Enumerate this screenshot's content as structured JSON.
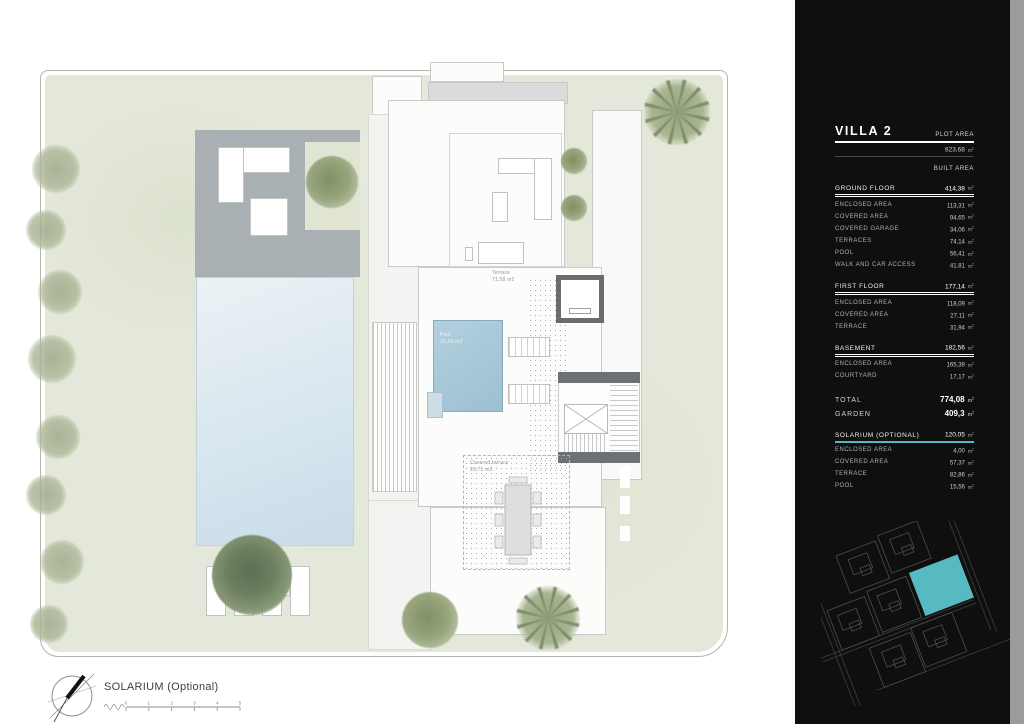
{
  "panel": {
    "title": "VILLA 2",
    "plot_area_label": "PLOT AREA",
    "plot_area_value": "823,68",
    "built_area_label": "BUILT AREA",
    "unit_base": "m",
    "unit_exp": "2",
    "sections": [
      {
        "name": "GROUND FLOOR",
        "value": "414,38",
        "rows": [
          {
            "label": "ENCLOSED AREA",
            "value": "113,31"
          },
          {
            "label": "COVERED AREA",
            "value": "94,65"
          },
          {
            "label": "COVERED GARAGE",
            "value": "34,06"
          },
          {
            "label": "TERRACES",
            "value": "74,14"
          },
          {
            "label": "POOL",
            "value": "56,41"
          },
          {
            "label": "WALK AND CAR ACCESS",
            "value": "41,81"
          }
        ]
      },
      {
        "name": "FIRST FLOOR",
        "value": "177,14",
        "rows": [
          {
            "label": "ENCLOSED AREA",
            "value": "118,09"
          },
          {
            "label": "COVERED AREA",
            "value": "27,11"
          },
          {
            "label": "TERRACE",
            "value": "31,94"
          }
        ]
      },
      {
        "name": "BASEMENT",
        "value": "182,56",
        "rows": [
          {
            "label": "ENCLOSED AREA",
            "value": "165,39"
          },
          {
            "label": "COURTYARD",
            "value": "17,17"
          }
        ]
      }
    ],
    "total": {
      "label": "TOTAL",
      "value": "774,08"
    },
    "garden": {
      "label": "GARDEN",
      "value": "409,3"
    },
    "solarium": {
      "name": "SOLARIUM (OPTIONAL)",
      "value": "120,05",
      "rows": [
        {
          "label": "ENCLOSED AREA",
          "value": "4,00"
        },
        {
          "label": "COVERED AREA",
          "value": "57,37"
        },
        {
          "label": "TERRACE",
          "value": "82,86"
        },
        {
          "label": "POOL",
          "value": "15,56"
        }
      ]
    }
  },
  "plan": {
    "pool_label": {
      "title": "Pool",
      "area": "15,56 m2"
    },
    "terrace_label": {
      "title": "Terrace",
      "area": "71,58 m2"
    },
    "pergola_label": {
      "title": "Covered terrace",
      "area": "29,71 m2"
    }
  },
  "footer": {
    "title": "SOLARIUM (Optional)",
    "scale_ticks": [
      "0",
      "1",
      "2",
      "3",
      "4",
      "5"
    ]
  },
  "colors": {
    "sage": "#e4e8da",
    "deck_grey": "#a9b0b3",
    "ground_pool": "#d9e7ef",
    "solarium_pool": "#a5c7d7",
    "structure_grey": "#6a6e70",
    "accent_teal": "#54b8c2",
    "panel_bg": "#0f0f0f"
  }
}
